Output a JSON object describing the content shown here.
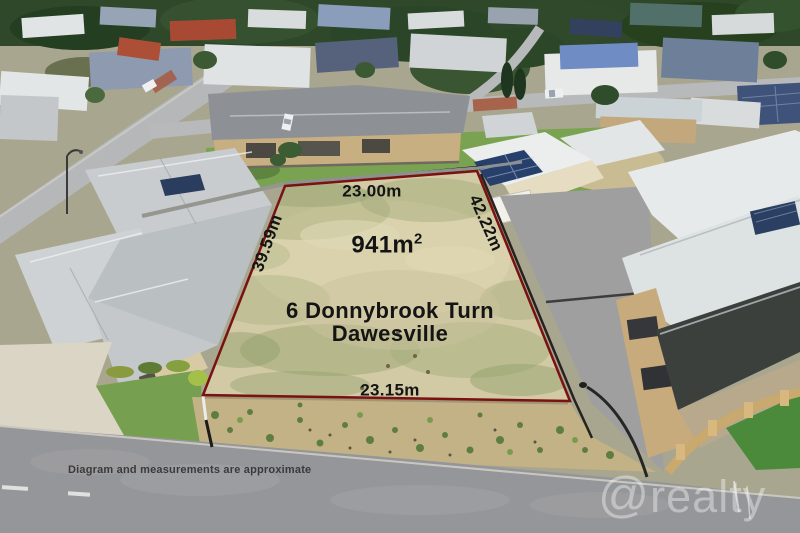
{
  "overlay": {
    "boundary": {
      "top": "23.00m",
      "left": "39.59m",
      "right": "42.22m",
      "bottom": "23.15m"
    },
    "area": {
      "value": "941m",
      "superscript": "2"
    },
    "address": {
      "line1": "6 Donnybrook Turn",
      "line2": "Dawesville"
    },
    "disclaimer": "Diagram and measurements are approximate",
    "watermark": {
      "at_symbol": "@",
      "name": "realty"
    }
  },
  "colors": {
    "boundary_line": "#7a1112",
    "lot_sand": "#d2caa5",
    "label_text": "#141414",
    "watermark_white": "#ffffff"
  }
}
